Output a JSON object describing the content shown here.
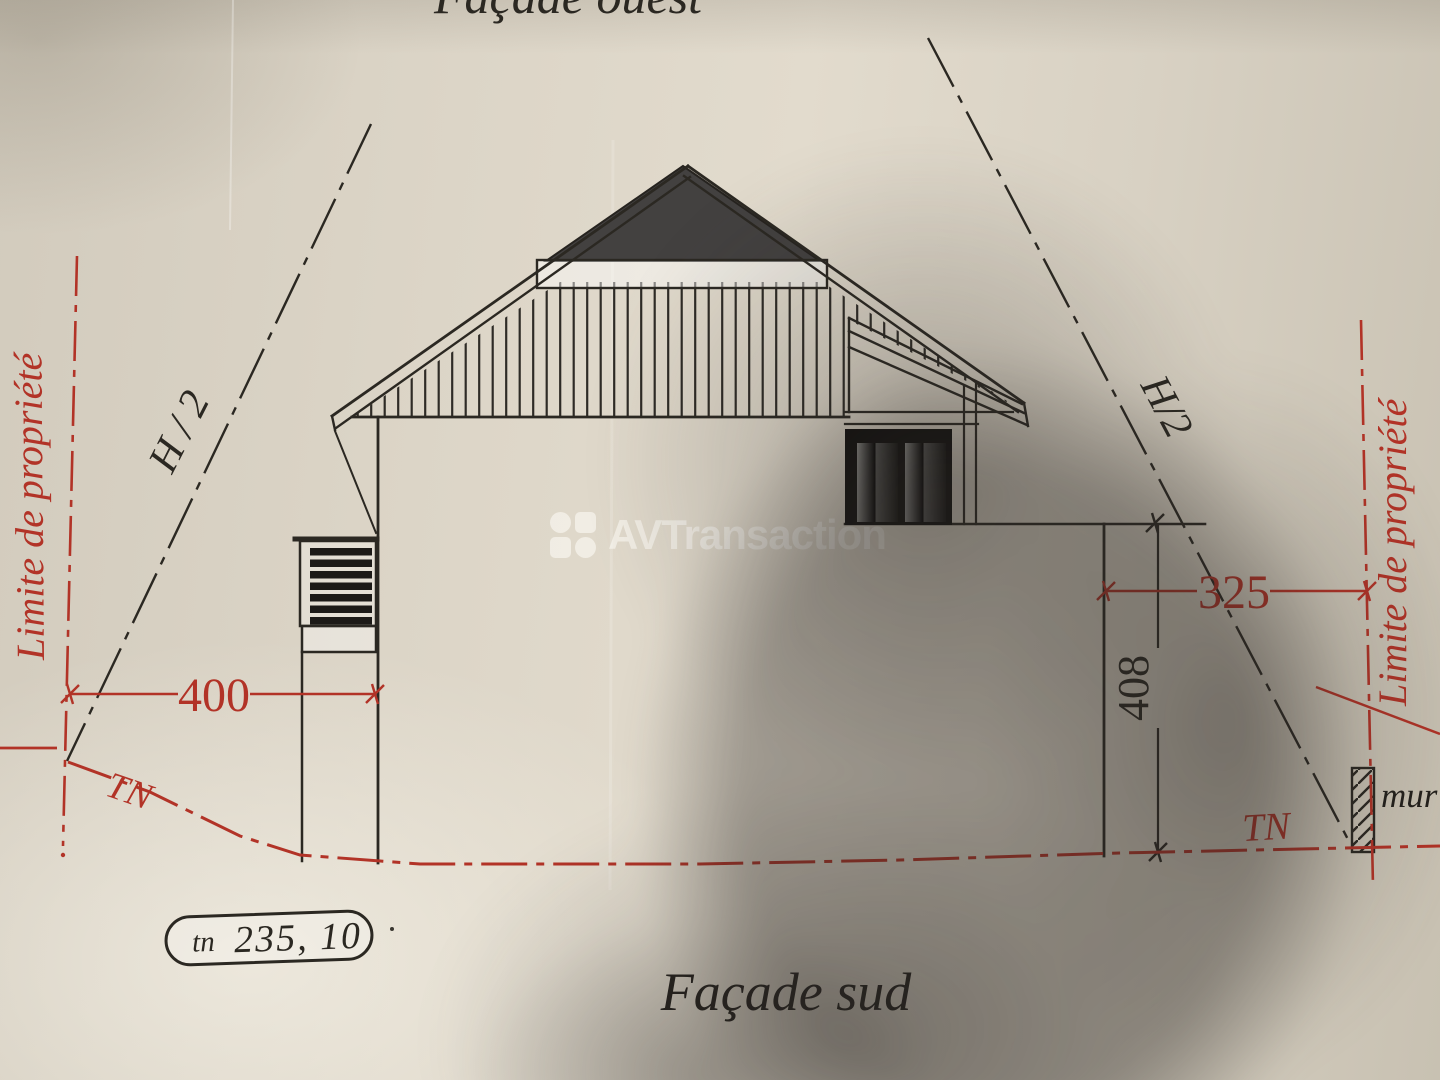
{
  "titles": {
    "top_partial": "Façade ouest",
    "bottom": "Façade sud"
  },
  "watermark": {
    "brand": "AVTransaction",
    "logo": "four-tile-logo"
  },
  "annotations": {
    "limit_left": "Limite de propriété",
    "limit_right": "Limite de propriété",
    "h_half_left": "H / 2",
    "h_half_right": "H/2",
    "tn_left": "TN",
    "tn_right": "TN",
    "wall_label": "mur",
    "ground_badge": {
      "prefix": "tn",
      "value": "235, 10"
    }
  },
  "dimensions": {
    "left_offset": "400",
    "right_offset": "325",
    "right_height": "408"
  },
  "colors": {
    "annotation_red": "#b23327",
    "ink": "#2b2822",
    "roof_dark": "#434140",
    "paper": "#d9d2c4"
  }
}
